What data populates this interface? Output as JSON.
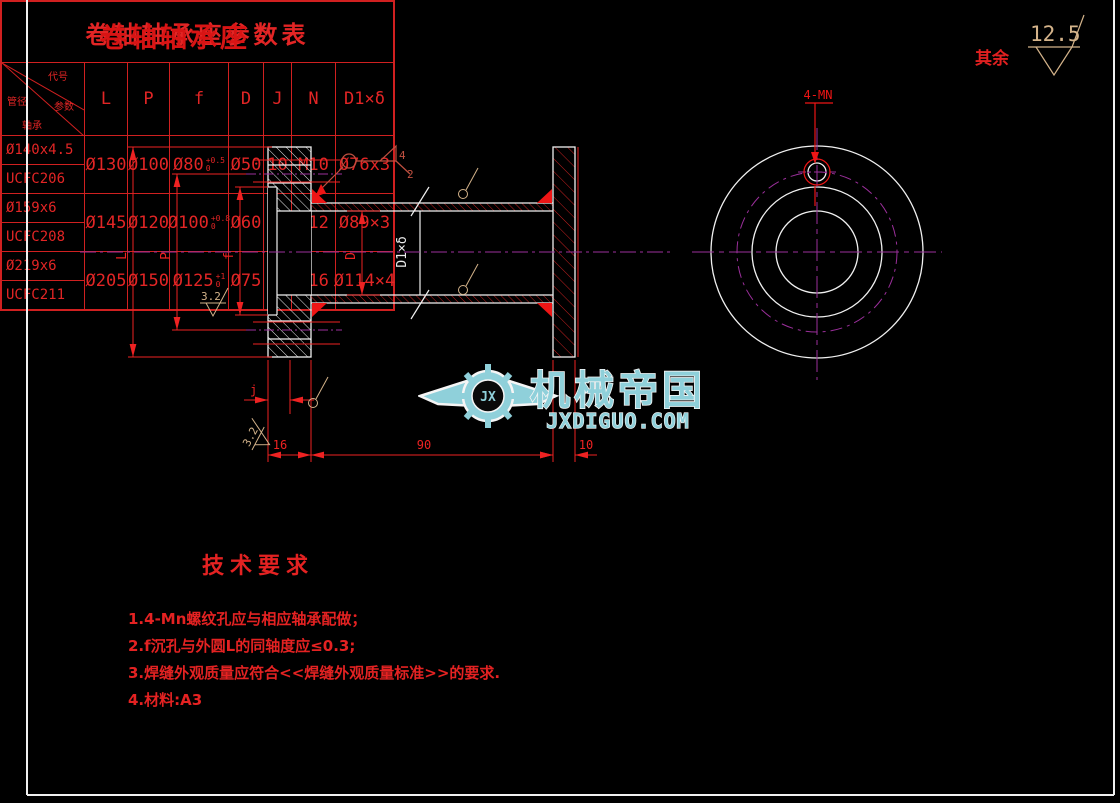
{
  "drawing": {
    "title": "卷轴轴承座",
    "surface_note": {
      "label": "其余",
      "value": "12.5"
    },
    "section_view": {
      "labels": {
        "L": "L",
        "P": "P",
        "f": "f",
        "D": "D",
        "D1": "D1×δ",
        "j": "j"
      },
      "roughness_top": "3.2",
      "roughness_bottom": "3.2",
      "weld": {
        "size": "4",
        "count": "2"
      },
      "dims": {
        "flange_left": "16",
        "tube": "90",
        "flange_right": "10"
      }
    },
    "end_view": {
      "hole_callout": "4-MN"
    },
    "tech_requirements": {
      "heading": "技术要求",
      "items": [
        "1.4-Mn螺纹孔应与相应轴承配做；",
        "2.f沉孔与外圆L的同轴度应≤0.3;",
        "3.焊缝外观质量应符合<<焊缝外观质量标准>>的要求.",
        "4.材料:A3"
      ]
    }
  },
  "watermark": {
    "logo_text": "JX",
    "brand": "机械帝国",
    "url": "JXDIGUO.COM"
  },
  "table": {
    "title": "卷轴轴承座参数表",
    "corner": {
      "top": "代号",
      "right": "参数",
      "left": "管径",
      "bottom": "轴承"
    },
    "columns": [
      "L",
      "P",
      "f",
      "D",
      "J",
      "N",
      "D1×δ"
    ],
    "rows": [
      {
        "pipe": "Ø140x4.5",
        "bearing": "UCFC206",
        "L": "Ø130",
        "P": "Ø100",
        "f": "Ø80",
        "f_tol_up": "+0.5",
        "f_tol_dn": "0",
        "D": "Ø50",
        "J": "10",
        "N": "M10",
        "D1": "Ø76x3"
      },
      {
        "pipe": "Ø159x6",
        "bearing": "UCFC208",
        "L": "Ø145",
        "P": "Ø120",
        "f": "Ø100",
        "f_tol_up": "+0.8",
        "f_tol_dn": "0",
        "D": "Ø60",
        "J": "11",
        "N": "M12",
        "D1": "Ø89×3"
      },
      {
        "pipe": "Ø219x6",
        "bearing": "UCFC211",
        "L": "Ø205",
        "P": "Ø150",
        "f": "Ø125",
        "f_tol_up": "+1",
        "f_tol_dn": "0",
        "D": "Ø75",
        "J": "13",
        "N": "M16",
        "D1": "Ø114×4"
      }
    ]
  }
}
